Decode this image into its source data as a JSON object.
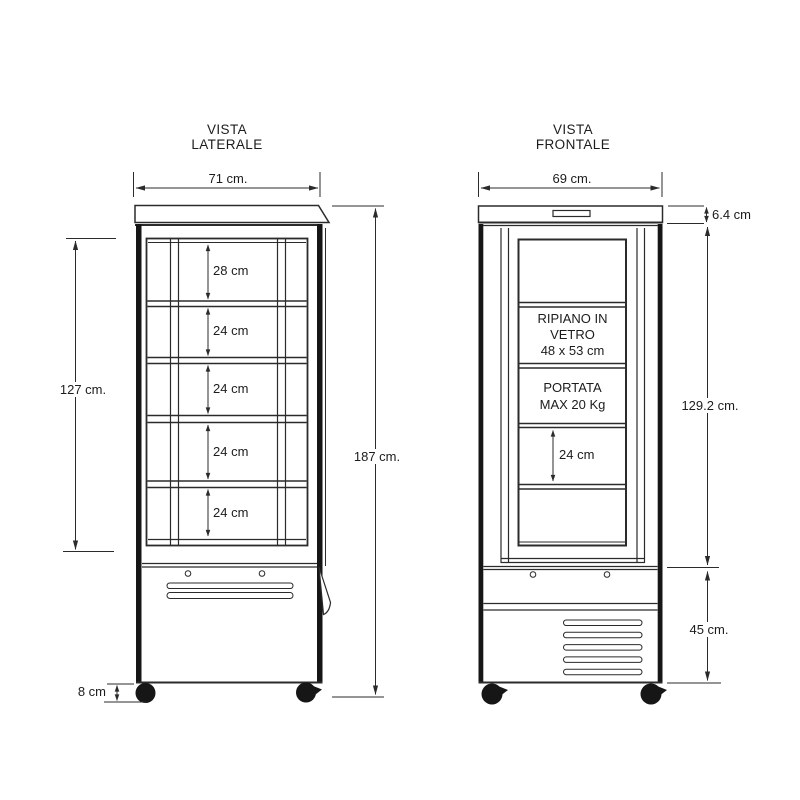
{
  "document": {
    "type": "technical dimension drawing",
    "subject": "upright glass display cabinet"
  },
  "side_view": {
    "title": [
      "VISTA",
      "LATERALE"
    ],
    "overall_width": "71 cm.",
    "shelf_gaps": [
      "28 cm",
      "24 cm",
      "24 cm",
      "24 cm",
      "24 cm"
    ],
    "glass_interior_height": "127 cm.",
    "overall_height": "187 cm.",
    "caster_height": "8 cm"
  },
  "front_view": {
    "title": [
      "VISTA",
      "FRONTALE"
    ],
    "overall_width": "69 cm.",
    "top_panel_height": "6.4 cm",
    "door_height": "129.2 cm.",
    "base_height": "45 cm.",
    "shelf_note": [
      "RIPIANO IN",
      "VETRO",
      "48 x 53 cm"
    ],
    "capacity_note": [
      "PORTATA",
      "MAX 20 Kg"
    ],
    "shelf_gap": "24 cm"
  },
  "colors": {
    "line": "#2b2b2b",
    "text": "#1c1c1c",
    "background": "#ffffff"
  }
}
